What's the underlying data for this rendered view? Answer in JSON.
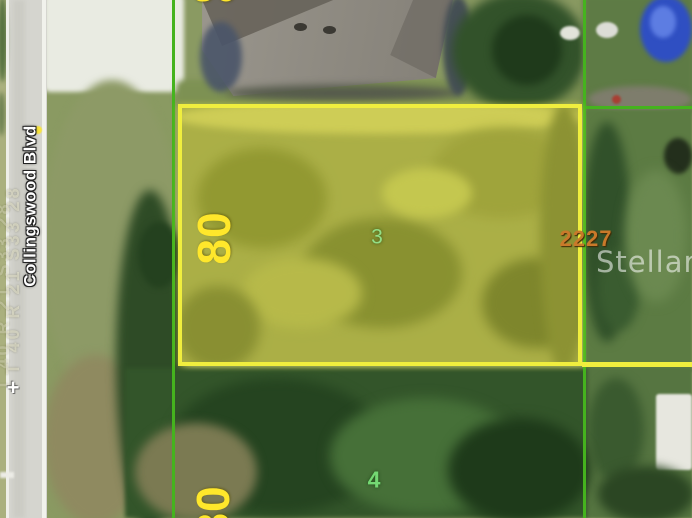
{
  "map": {
    "street_label": "Collingswood Blvd",
    "trs_label": "T 40 R 21 S33 28",
    "watermark": "Stellar MLS",
    "parcels": {
      "lot_top": {
        "width_label": "80"
      },
      "lot3": {
        "number": "3",
        "width_label": "80",
        "address": "2227"
      },
      "lot4": {
        "number": "4",
        "width_label": "80"
      }
    },
    "markers": {
      "cross": "+"
    }
  },
  "colors": {
    "parcel-yellow": "#f0ee3e",
    "line-green": "#45b31e",
    "dim-yellow": "#ffe72b",
    "lot3-number-green": "#93de86",
    "lot4-number-green": "#74d873",
    "address-orange": "#c9792a",
    "watermark-white": "rgba(255,255,255,0.55)",
    "street-white": "#ffffff",
    "trs-faint": "rgba(245,243,220,0.5)"
  }
}
